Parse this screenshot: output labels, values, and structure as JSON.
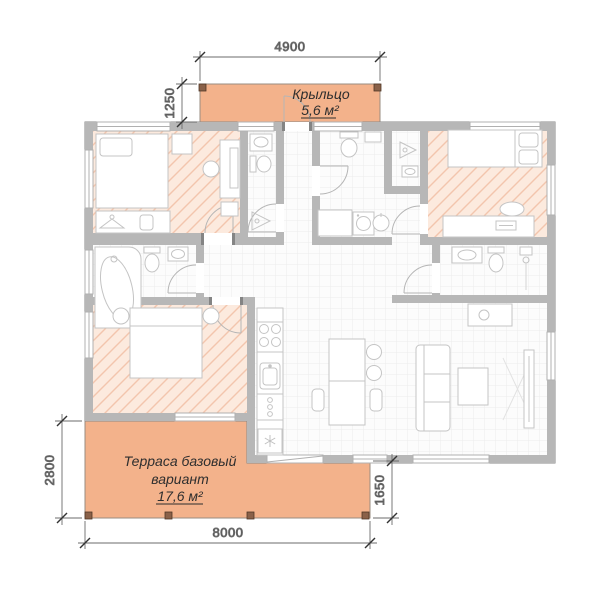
{
  "labels": {
    "porch": {
      "title": "Крыльцо",
      "area": "5,6 м²"
    },
    "terrace": {
      "line1": "Терраса базовый",
      "line2": "вариант",
      "area": "17,6 м²"
    }
  },
  "dims": {
    "top": "4900",
    "porch_depth": "1250",
    "terrace_height": "2800",
    "terrace_width": "8000",
    "terrace_right": "1650"
  },
  "colors": {
    "deck_fill": "#f3b28b",
    "deck_stroke": "#9a8c80",
    "room_hatch_fill": "#fceade",
    "room_hatch_line": "#f3c5ad",
    "wall_fill": "#b7b7b7",
    "floor_fill": "#fcfcfc",
    "floor_grid_line": "#ececec",
    "furniture_stroke": "#c4c4c4",
    "dimension_color": "#383838",
    "post_fill": "#8a6149"
  }
}
